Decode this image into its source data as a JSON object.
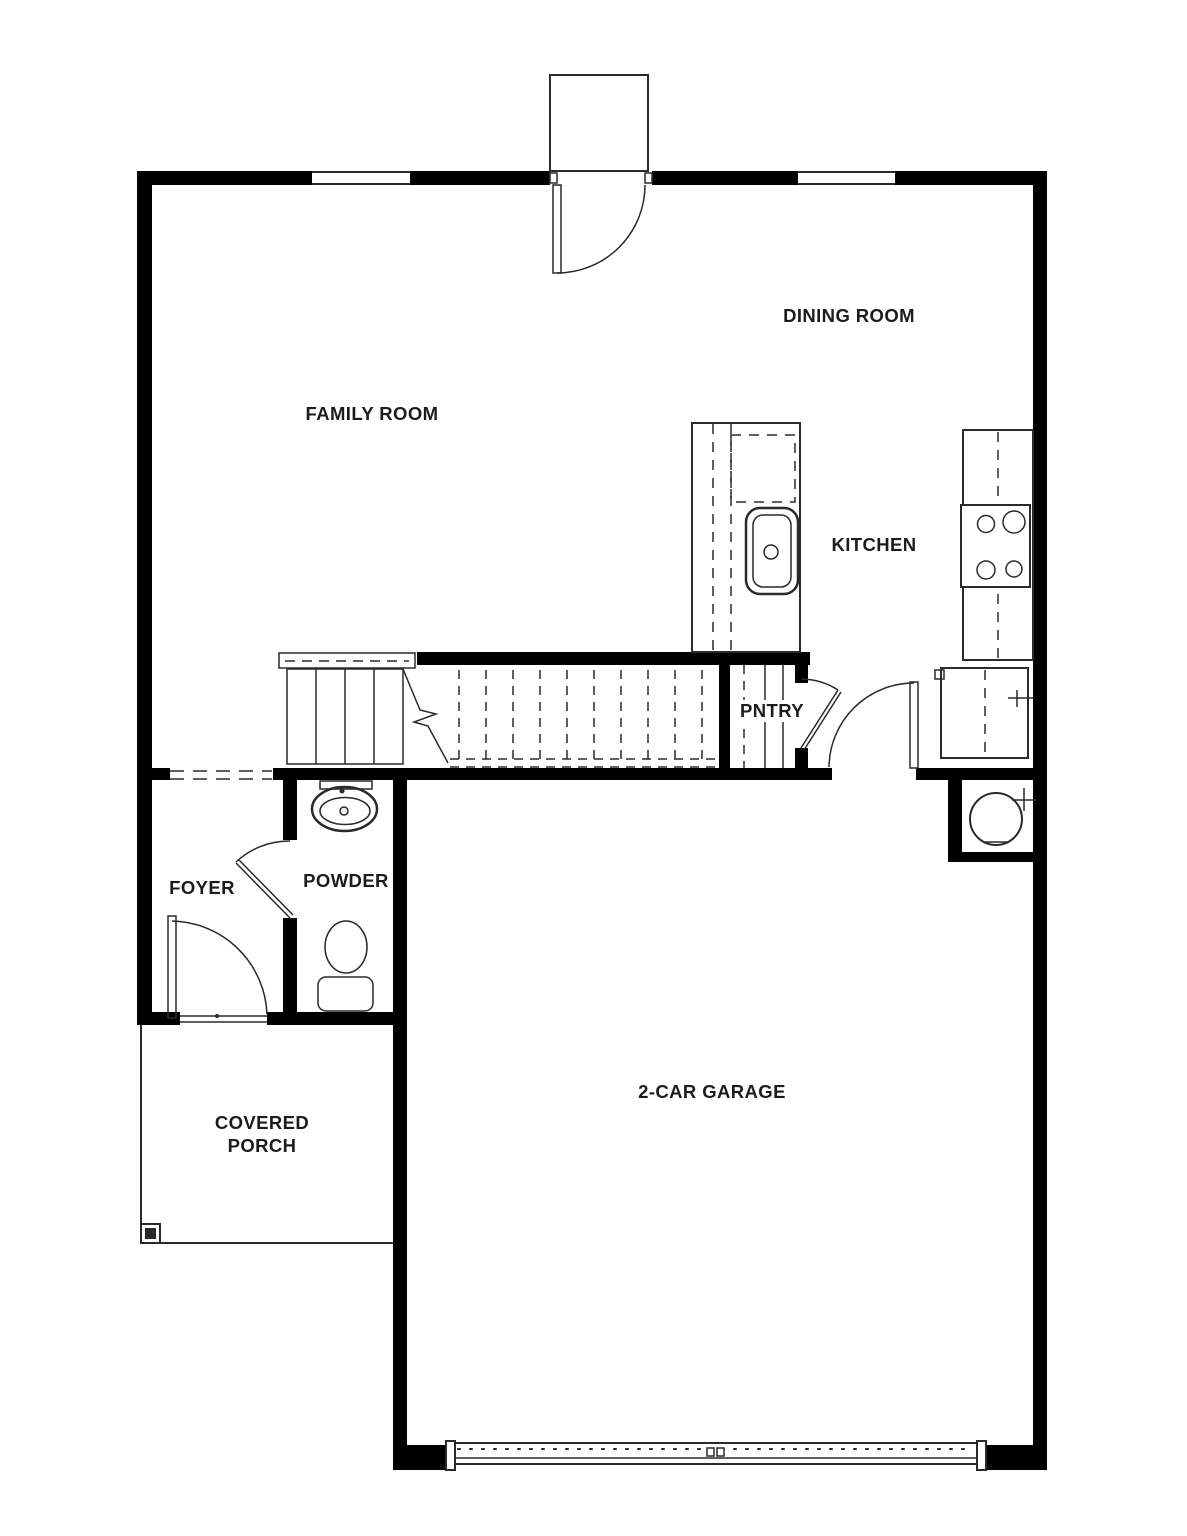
{
  "rooms": {
    "family_room": "FAMILY ROOM",
    "dining_room": "DINING ROOM",
    "kitchen": "KITCHEN",
    "pantry": "PNTRY",
    "foyer": "FOYER",
    "powder": "POWDER",
    "covered_porch": "COVERED PORCH",
    "garage": "2-CAR GARAGE"
  },
  "colors": {
    "wall": "#000000",
    "line": "#2a2a2a",
    "background": "#ffffff",
    "label": "#1c1c1c"
  }
}
